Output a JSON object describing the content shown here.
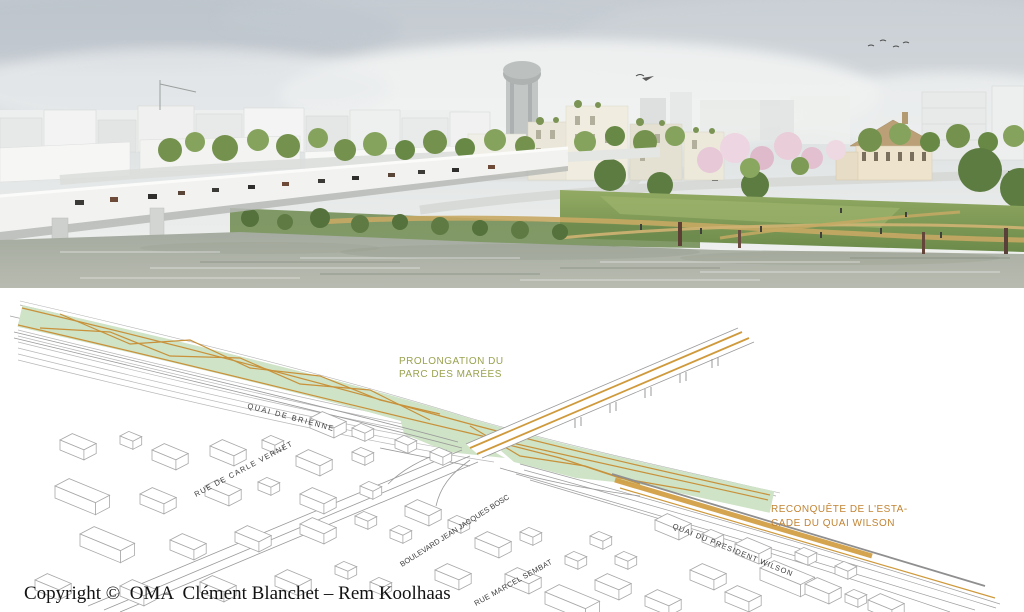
{
  "panorama": {
    "scene": "riverfront-urban-park-rendering",
    "colors": {
      "sky": "#d9dee0",
      "water": "#aab0a5",
      "foliage": "#74924e",
      "blossom": "#e6c8d7",
      "bridge": "#f2f3f1",
      "buildings": "#eceadd"
    }
  },
  "map": {
    "street_label_color": "#3c3c3c",
    "street_labels": [
      "QUAI DE BRIENNE",
      "RUE DE CARLE VERNET",
      "BOULEVARD JEAN JACQUES BOSC",
      "RUE MARCEL SEMBAT",
      "QUAI DU PRESIDENT WILSON"
    ],
    "annotations": {
      "parc": {
        "line1": "PROLONGATION DU",
        "line2": "PARC DES MARÉES",
        "color": "#9aa24f"
      },
      "estacade": {
        "line1": "RECONQUÊTE DE L'ESTA-",
        "line2": "CADE DU QUAI WILSON",
        "color": "#c28433"
      }
    },
    "colors": {
      "park_band": "#cfe3c6",
      "path_orange": "#cf9a3c",
      "line_gray": "#9a9a9a"
    }
  },
  "footer": {
    "copyright": "Copyright ©  OMA  Clément Blanchet – Rem Koolhaas"
  }
}
